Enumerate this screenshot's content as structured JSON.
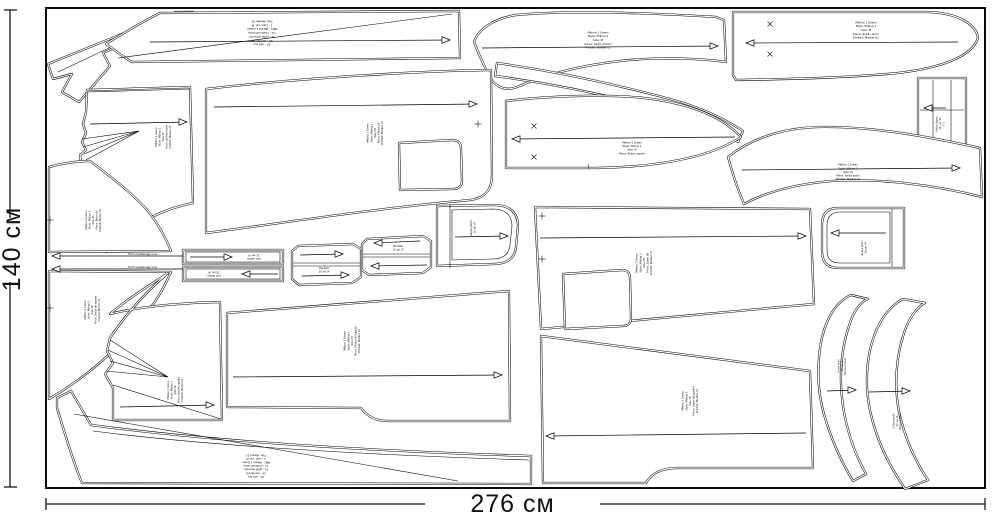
{
  "page": {
    "background": "#ffffff",
    "line_color": "#000000"
  },
  "dimensions": {
    "height_label": "140 см",
    "width_label": "276 см"
  },
  "fold_lines": [
    {
      "y": 256,
      "x1": 52,
      "x2": 183,
      "label": "Fold Line/Selvage Line"
    },
    {
      "y": 269,
      "x1": 52,
      "x2": 183,
      "label": "Fold Line/Selvage Line"
    }
  ],
  "instruction_label_lines": [
    "2X - ušít švy",
    "2X - obnitkovat",
    "3X - přišít lemovku",
    "C1 - omítnout okraj",
    "MB1 - Mikina 1 Green",
    "1 - Lem, vel. M",
    "Tisk: Marker 01"
  ],
  "pieces": [
    {
      "id": "collar-strip",
      "path": "M 176,12 L 193,12 L 103,53 L 110,66 L 79,102 L 62,92 L 72,74 L 53,79 L 48,64 Z",
      "inner": [
        "M 181,14 L 58,72"
      ]
    },
    {
      "id": "hem-band-top",
      "path": "M 160,13 L 459,11 L 460,58 L 132,62 C 120,55 112,48 106,44 C 122,34 142,22 160,13 Z",
      "inner": [
        "M 118,58 L 452,14"
      ],
      "arrows": [
        {
          "x1": 150,
          "y1": 42,
          "x2": 450,
          "y2": 40,
          "head": "right"
        }
      ],
      "label": {
        "x": 262,
        "y": 33,
        "rot": 180,
        "size": 2.8,
        "lines": [
          "2X - ušít švy",
          "2X - obnitkovat",
          "3X - přišít lemovku",
          "C1 - omítnout okraj",
          "MB1 - Mikina 1 Green",
          "1 - Lem, vel. M",
          "Tisk: Marker 01"
        ]
      }
    },
    {
      "id": "yoke-front",
      "path": "M 474,42 C 478,30 492,19 516,15 C 570,10 650,13 716,17 L 724,20 L 726,62 C 698,58 655,57 620,61 C 575,66 540,77 517,87 C 504,92 493,86 487,72 C 482,61 477,50 474,42 Z",
      "arrows": [
        {
          "x1": 482,
          "y1": 48,
          "x2": 718,
          "y2": 46,
          "head": "right"
        }
      ],
      "label": {
        "x": 598,
        "y": 40,
        "rot": 0,
        "size": 2.8,
        "lines": [
          "Mikina 1 Green",
          "Style: Mikina 1",
          "Size: M",
          "Piece: Sedlo přední",
          "Printed: Marker 01"
        ]
      }
    },
    {
      "id": "sleeve-top",
      "path": "M 733,12 L 928,12 C 958,13 976,24 978,38 C 972,57 940,68 898,73 C 845,78 790,79 736,80 L 733,75 Z",
      "arrows": [
        {
          "x1": 746,
          "y1": 43,
          "x2": 958,
          "y2": 42,
          "head": "left"
        }
      ],
      "marks": [
        {
          "type": "x",
          "x": 770,
          "y": 24
        },
        {
          "type": "x",
          "x": 770,
          "y": 54
        }
      ],
      "label": {
        "x": 866,
        "y": 30,
        "rot": 0,
        "size": 2.8,
        "lines": [
          "Mikina 1 Green",
          "Style: Mikina 1",
          "Size: M",
          "Piece: Rukáv horní",
          "Printed: Marker 01"
        ]
      }
    },
    {
      "id": "pocket-flap",
      "path": "M 918,78 L 966,78 L 966,145 L 918,145 Z",
      "inner": [
        "M 933,80 L 933,143",
        "M 951,80 L 951,143",
        "M 920,110 L 964,110"
      ],
      "arrows": [
        {
          "x1": 924,
          "y1": 108,
          "x2": 946,
          "y2": 108,
          "head": "left"
        }
      ],
      "label": {
        "x": 940,
        "y": 124,
        "rot": -90,
        "size": 2.5,
        "lines": [
          "Patka kapsy",
          "1X  vel. M",
          "F 1"
        ]
      }
    },
    {
      "id": "binding-ribbon",
      "path": "M 497,63 C 560,72 622,86 670,99 C 700,107 725,119 743,131 L 738,142 C 718,129 692,118 662,110 C 615,97 556,84 495,76 Z"
    },
    {
      "id": "yoke-back",
      "path": "M 728,157 C 750,139 782,128 818,127 C 870,126 926,136 980,148 L 982,197 C 935,185 880,178 832,181 C 792,184 762,194 744,204 C 738,190 732,172 728,157 Z",
      "arrows": [
        {
          "x1": 742,
          "y1": 170,
          "x2": 960,
          "y2": 168,
          "head": "right"
        }
      ],
      "label": {
        "x": 848,
        "y": 172,
        "rot": 0,
        "size": 2.6,
        "lines": [
          "Mikina 1 Green",
          "Style: Mikina 1",
          "Size: M",
          "Piece: Sedlo zadní",
          "Printed: Marker 01"
        ]
      }
    },
    {
      "id": "sleeve-under",
      "path": "M 506,101 C 540,97 580,95 612,96 C 668,97 716,110 741,137 C 706,160 650,167 596,168 L 506,168 Z",
      "inner": [
        "M 588,164 L 589,169"
      ],
      "arrows": [
        {
          "x1": 512,
          "y1": 139,
          "x2": 735,
          "y2": 137,
          "head": "left"
        }
      ],
      "marks": [
        {
          "type": "x",
          "x": 534,
          "y": 126
        },
        {
          "type": "x",
          "x": 534,
          "y": 157
        }
      ],
      "label": {
        "x": 632,
        "y": 148,
        "rot": 0,
        "size": 2.6,
        "lines": [
          "Mikina 1 Green",
          "Style: Mikina 1",
          "Size: M",
          "Piece: Rukáv spodní"
        ]
      }
    },
    {
      "id": "front-panel",
      "path": "M 206,89 C 300,78 420,71 491,70 L 492,175 C 492,190 485,198 470,200 L 460,201 C 380,208 290,222 206,233 Z",
      "cutouts": [
        "M 399,143 L 452,140 C 458,140 461,143 461,149 L 462,180 C 462,186 459,189 453,189 L 400,190 Z"
      ],
      "arrows": [
        {
          "x1": 214,
          "y1": 107,
          "x2": 477,
          "y2": 104,
          "head": "right"
        }
      ],
      "marks": [
        {
          "type": "plus",
          "x": 478,
          "y": 124
        }
      ],
      "label": {
        "x": 375,
        "y": 133,
        "rot": -90,
        "size": 2.6,
        "lines": [
          "Mikina 1 Green",
          "Style: Mikina 1",
          "Size: M",
          "Piece: Přední díl",
          "Printed: Marker 01"
        ]
      }
    },
    {
      "id": "back-panel",
      "path": "M 535,207 L 810,209 L 814,304 L 541,329 Z",
      "cutouts": [
        "M 563,274 L 622,270 C 627,270 630,273 630,278 L 631,318 C 631,323 628,326 623,326 L 565,329 Z"
      ],
      "arrows": [
        {
          "x1": 540,
          "y1": 238,
          "x2": 806,
          "y2": 236,
          "head": "right"
        }
      ],
      "marks": [
        {
          "type": "plus",
          "x": 542,
          "y": 216
        },
        {
          "type": "plus",
          "x": 542,
          "y": 259
        }
      ],
      "label": {
        "x": 644,
        "y": 263,
        "rot": -90,
        "size": 2.6,
        "lines": [
          "Mikina 1 Green",
          "Style: Mikina 1",
          "Size: M",
          "Piece: Zadní díl",
          "Printed: Marker 01"
        ]
      }
    },
    {
      "id": "back-lower",
      "path": "M 541,336 L 810,371 L 813,468 L 678,468 C 660,468 651,474 646,483 L 543,483 Z",
      "arrows": [
        {
          "x1": 546,
          "y1": 436,
          "x2": 806,
          "y2": 433,
          "head": "left"
        }
      ],
      "label": {
        "x": 690,
        "y": 401,
        "rot": -90,
        "size": 2.6,
        "lines": [
          "Mikina 1 Green",
          "Style: Mikina 1",
          "Size: M",
          "Piece: Zadní díl spodní",
          "Printed: Marker 01"
        ]
      }
    },
    {
      "id": "front-lower",
      "path": "M 227,313 L 509,291 L 510,421 L 388,421 C 374,421 366,415 361,408 L 227,407 Z",
      "arrows": [
        {
          "x1": 233,
          "y1": 377,
          "x2": 502,
          "y2": 375,
          "head": "right"
        }
      ],
      "label": {
        "x": 352,
        "y": 341,
        "rot": -90,
        "size": 2.6,
        "lines": [
          "Mikina 1 Green",
          "Style: Mikina 1",
          "Size: M",
          "Piece: Přední díl spodní",
          "Printed: Marker 01"
        ]
      }
    },
    {
      "id": "side-upper",
      "path": "M 87,90 L 190,87 L 193,203 C 163,209 137,222 118,243 L 106,252 C 98,231 89,206 84,180 C 82,170 81,162 80,155 L 86,150 L 82,142 L 86,133 L 83,124 L 86,112 Z",
      "inner": [
        "M 82,139 L 139,131",
        "M 83,147 L 139,131",
        "M 84,154 L 139,131",
        "M 86,160 L 139,131",
        "M 88,92 L 190,89"
      ],
      "arrows": [
        {
          "x1": 90,
          "y1": 124,
          "x2": 187,
          "y2": 122,
          "head": "right"
        }
      ],
      "label": {
        "x": 163,
        "y": 137,
        "rot": -90,
        "size": 2.5,
        "lines": [
          "Mikina 1 Green",
          "Style: Mikina 1",
          "Size: M",
          "Piece: Bočník horní",
          "Printed: Marker 01"
        ]
      }
    },
    {
      "id": "side-left",
      "path": "M 49,167 C 64,163 78,161 90,161 C 110,176 132,193 148,211 C 158,224 166,238 171,251 L 49,252 Z",
      "marks": [
        {
          "type": "plus",
          "x": 50,
          "y": 220
        }
      ],
      "label": {
        "x": 93,
        "y": 220,
        "rot": -90,
        "size": 2.5,
        "lines": [
          "Mikina 1 Green",
          "Style: Mikina 1",
          "Size: M",
          "Piece: Boční díl",
          "Printed: Marker 01"
        ]
      }
    },
    {
      "id": "side-left-lower",
      "path": "M 49,271 L 171,272 C 164,288 154,305 140,322 C 118,348 90,375 49,399 Z",
      "marks": [
        {
          "type": "plus",
          "x": 50,
          "y": 308
        }
      ],
      "label": {
        "x": 92,
        "y": 310,
        "rot": -90,
        "size": 2.5,
        "lines": [
          "Mikina 1 Green",
          "Style: Mikina 1",
          "Size: M",
          "Piece: Boční díl spodní",
          "Printed: Marker 01"
        ]
      }
    },
    {
      "id": "side-lower",
      "path": "M 168,273 C 147,287 126,300 110,314 C 142,306 180,303 220,302 L 222,420 L 113,420 L 113,388 L 105,374 L 113,363 L 107,351 L 110,338 C 126,314 146,292 168,273 Z",
      "inner": [
        "M 106,371 L 168,377",
        "M 110,361 L 168,377",
        "M 108,350 L 168,377",
        "M 110,340 L 168,377",
        "M 113,385 L 221,419"
      ],
      "arrows": [
        {
          "x1": 120,
          "y1": 407,
          "x2": 214,
          "y2": 405,
          "head": "right"
        }
      ],
      "label": {
        "x": 175,
        "y": 390,
        "rot": -90,
        "size": 2.5,
        "lines": [
          "Mikina 1 Green",
          "Style: Mikina 1",
          "Size: M",
          "Piece: Bočník spodní",
          "Printed: Marker 01"
        ]
      }
    },
    {
      "id": "hem-band-bottom",
      "path": "M 57,398 L 71,391 L 91,425 C 210,441 370,451 531,456 L 531,484 L 82,483 C 73,462 62,424 57,408 Z",
      "inner": [
        "M 93,431 C 210,446 370,455 529,460",
        "M 74,414 L 458,481"
      ],
      "label": {
        "x": 256,
        "y": 466,
        "rot": 180,
        "size": 2.6,
        "lines": [
          "2X - ušít švy",
          "2X - obnitkovat",
          "3X - přišít lemovku",
          "C1 - omítnout okraj",
          "MB1 - Mikina 1 Green",
          "1 - Lem, vel. M",
          "Tisk: Marker 01"
        ]
      }
    },
    {
      "id": "cuff-strip-1",
      "path": "M 183,250 L 283,250 L 283,264 L 183,264 Z",
      "inner": [
        "M 186,252 L 280,252 L 280,262 L 186,262 Z"
      ],
      "arrows": [
        {
          "x1": 190,
          "y1": 257,
          "x2": 232,
          "y2": 257,
          "head": "right"
        }
      ],
      "label": {
        "x": 254,
        "y": 257,
        "rot": 180,
        "size": 2.4,
        "lines": [
          "Lem rukávu",
          "2X  vel. M"
        ]
      }
    },
    {
      "id": "cuff-strip-2",
      "path": "M 183,267 L 283,267 L 283,281 L 183,281 Z",
      "inner": [
        "M 186,269 L 280,269 L 280,279 L 186,279 Z"
      ],
      "arrows": [
        {
          "x1": 242,
          "y1": 274,
          "x2": 278,
          "y2": 274,
          "head": "left"
        }
      ],
      "label": {
        "x": 214,
        "y": 274,
        "rot": 180,
        "size": 2.4,
        "lines": [
          "Lem rukávu",
          "2X  vel. M"
        ]
      }
    },
    {
      "id": "cuff-left",
      "path": "M 298,246 L 353,244 L 361,249 L 361,277 L 352,283 L 299,285 L 292,279 L 292,251 Z",
      "inner": [
        "M 293,263 L 360,263",
        "M 293,266 L 360,266"
      ],
      "arrows": [
        {
          "x1": 300,
          "y1": 255,
          "x2": 343,
          "y2": 254,
          "head": "right"
        },
        {
          "x1": 302,
          "y1": 276,
          "x2": 349,
          "y2": 275,
          "head": "right"
        }
      ],
      "label": {
        "x": 324,
        "y": 270,
        "rot": 0,
        "size": 2.3,
        "lines": [
          "Manžeta",
          "2X  vel. M"
        ]
      }
    },
    {
      "id": "cuff-right",
      "path": "M 367,239 L 423,236 L 431,241 L 431,267 L 423,273 L 369,275 L 362,270 L 362,244 Z",
      "inner": [
        "M 363,254 L 430,254",
        "M 363,257 L 430,257"
      ],
      "arrows": [
        {
          "x1": 374,
          "y1": 243,
          "x2": 420,
          "y2": 241,
          "head": "left"
        },
        {
          "x1": 371,
          "y1": 266,
          "x2": 427,
          "y2": 265,
          "head": "left"
        }
      ],
      "label": {
        "x": 398,
        "y": 248,
        "rot": 0,
        "size": 2.3,
        "lines": [
          "Manžeta",
          "2X  vel. M"
        ]
      }
    },
    {
      "id": "pocket-front",
      "path": "M 437,206 L 494,205 C 510,205 518,213 518,226 L 516,247 C 515,258 507,264 494,264 L 437,266 Z",
      "inner": [
        "M 450,207 L 450,265",
        "M 452,210 L 493,209 C 505,209 512,215 512,226 L 510,245 C 509,254 503,259 493,259 L 452,260 Z",
        "M 450,204 L 450,208",
        "M 450,264 L 450,268"
      ],
      "arrows": [
        {
          "x1": 455,
          "y1": 237,
          "x2": 508,
          "y2": 236,
          "head": "right"
        }
      ],
      "label": {
        "x": 473,
        "y": 228,
        "rot": -90,
        "size": 2.4,
        "lines": [
          "Kapsa přední",
          "1X  vel. M"
        ]
      }
    },
    {
      "id": "pocket-side",
      "path": "M 904,208 L 904,268 L 838,268 C 827,268 822,262 822,251 L 822,225 C 822,214 827,208 838,208 Z",
      "inner": [
        "M 892,209 L 892,267",
        "M 890,212 L 840,212 C 831,212 827,217 827,226 L 827,250 C 827,259 831,263 840,263 L 890,263 Z"
      ],
      "arrows": [
        {
          "x1": 831,
          "y1": 233,
          "x2": 886,
          "y2": 233,
          "head": "left"
        }
      ],
      "label": {
        "x": 864,
        "y": 248,
        "rot": -90,
        "size": 2.4,
        "lines": [
          "Kapsa boční",
          "1X  vel. M"
        ]
      }
    },
    {
      "id": "collar-1",
      "path": "M 851,295 C 836,302 826,318 821,342 C 816,372 818,398 827,424 C 834,446 844,466 853,481 L 866,474 C 856,456 847,432 843,406 C 839,378 841,350 849,326 C 853,312 860,302 868,299 Z",
      "arrows": [
        {
          "x1": 827,
          "y1": 391,
          "x2": 856,
          "y2": 390,
          "head": "right"
        }
      ],
      "label": {
        "x": 842,
        "y": 366,
        "rot": -90,
        "size": 2.3,
        "lines": [
          "Límec horní",
          "1X  vel. M",
          "Mikina 1 Green"
        ]
      }
    },
    {
      "id": "collar-2",
      "path": "M 903,299 C 888,307 876,324 870,350 C 864,380 867,406 876,432 C 883,454 894,472 905,489 L 928,480 C 915,461 905,438 899,412 C 894,385 896,357 904,333 C 909,318 917,307 925,303 Z",
      "arrows": [
        {
          "x1": 869,
          "y1": 392,
          "x2": 910,
          "y2": 391,
          "head": "right"
        }
      ],
      "label": {
        "x": 897,
        "y": 421,
        "rot": -90,
        "size": 2.3,
        "lines": [
          "Límec spodní",
          "1X  vel. M",
          "Mikina 1 Green"
        ]
      }
    }
  ]
}
